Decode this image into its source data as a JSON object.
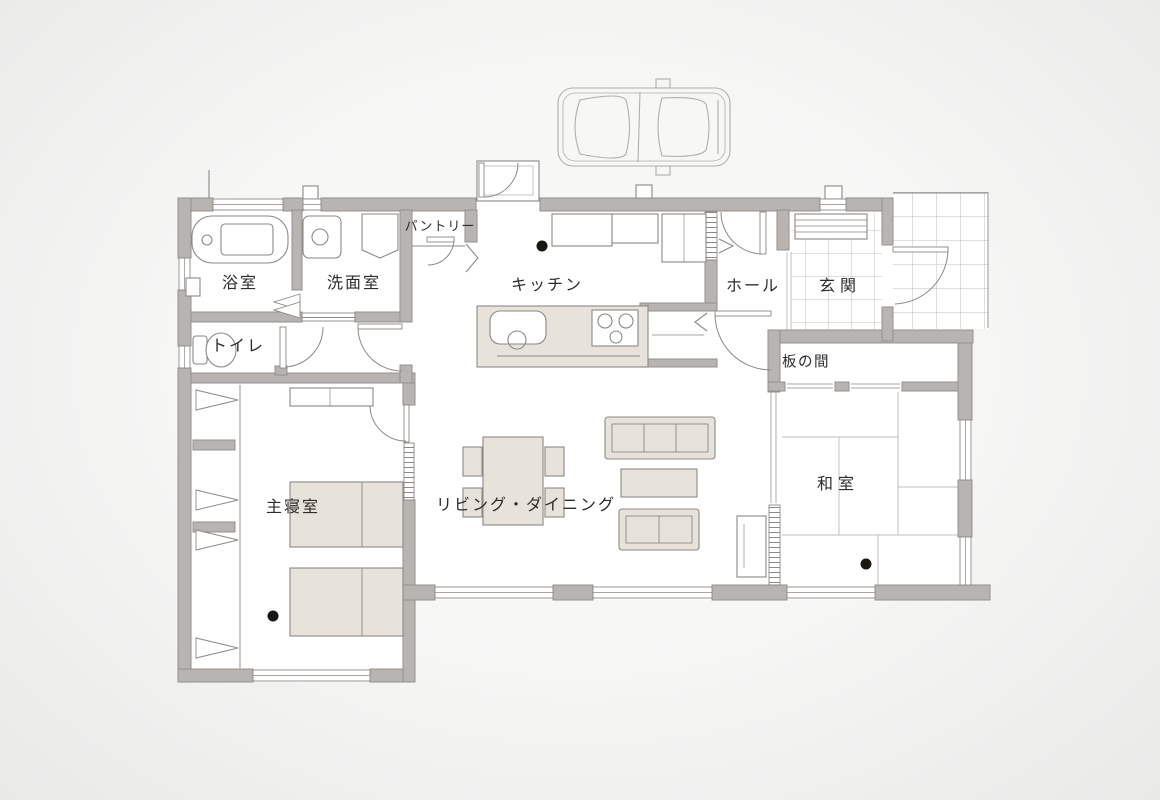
{
  "rooms": {
    "bathroom": "浴室",
    "washroom": "洗面室",
    "toilet": "トイレ",
    "pantry": "パントリー",
    "kitchen": "キッチン",
    "hall": "ホール",
    "entrance": "玄関",
    "wood_floor_room": "板の間",
    "japanese_room": "和室",
    "master_bedroom": "主寝室",
    "living_dining": "リビング・ダイニング"
  },
  "markers": {
    "ceiling_light_dots": 3,
    "vehicle_icon": "car-top-view"
  },
  "colors": {
    "wall": "#b7b4b1",
    "wall_edge": "#94918d",
    "line": "#8c8985",
    "floor": "#ffffff",
    "furniture": "#e7e3db",
    "tile": "#c2bfbb",
    "sketch": "#b2afab",
    "text": "#2e2b29",
    "dot": "#1a1713",
    "bg_inner": "#f7f7f6",
    "bg_outer": "#e9e9e8"
  }
}
